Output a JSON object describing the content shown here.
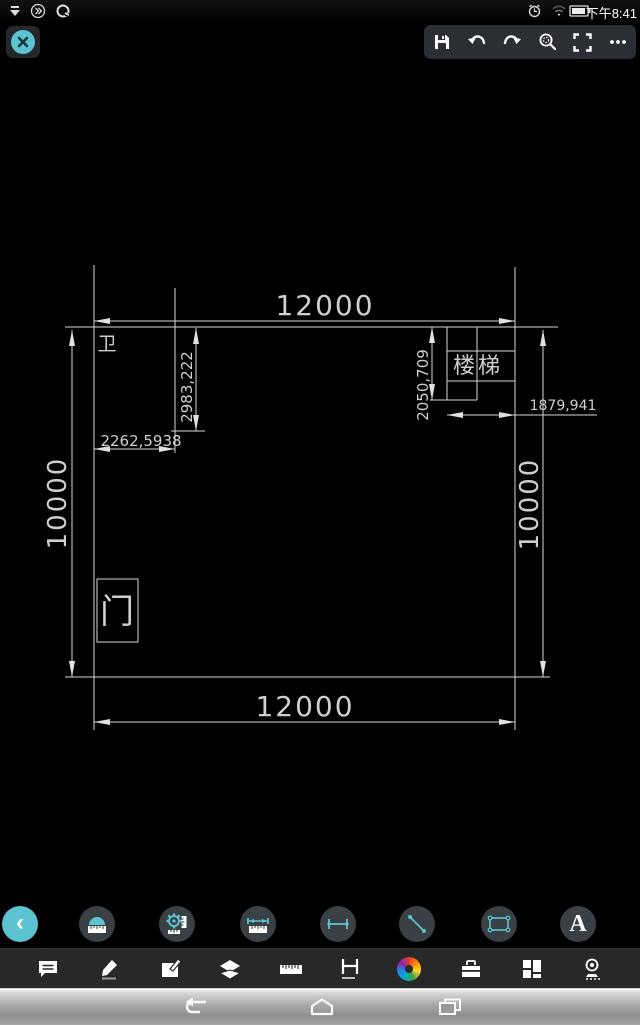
{
  "status_bar": {
    "time": "下午8:41",
    "icons_left": [
      "download-icon",
      "forward-circle-icon",
      "app-notification-icon"
    ],
    "icons_right": [
      "alarm-icon",
      "wifi-icon",
      "battery-icon"
    ]
  },
  "top_toolbar": {
    "buttons": [
      "close",
      "save",
      "undo",
      "redo",
      "zoom",
      "fullscreen",
      "more"
    ]
  },
  "drawing": {
    "dimensions": {
      "top_width": "12000",
      "bottom_width": "12000",
      "left_height": "10000",
      "right_height": "10000",
      "bath_height": "2983,222",
      "bath_width": "2262,5938",
      "stair_height": "2050,709",
      "stair_width": "1879,941"
    },
    "rooms": {
      "bathroom": "卫",
      "stairs": "楼梯",
      "door": "门"
    },
    "line_color": "#d6d6d6"
  },
  "tool_palette": {
    "text_tool_label": "A",
    "items": [
      "collapse-button",
      "arc-measure-tool",
      "scale-settings-tool",
      "dimension-measure-tool",
      "dimension-line-tool",
      "line-tool",
      "rectangle-tool",
      "text-tool"
    ]
  },
  "bottom_toolbar": {
    "items": [
      "comment-tool",
      "pencil-tool",
      "edit-note-tool",
      "layers-tool",
      "ruler-tool",
      "layout-tool",
      "color-wheel-tool",
      "toolbox-tool",
      "blocks-tool",
      "webcam-tool"
    ]
  },
  "nav_bar": {
    "items": [
      "back",
      "home",
      "recents"
    ]
  },
  "colors": {
    "accent_teal": "#5cc3d1",
    "toolbar_bg": "#2b2f33",
    "bottom_bar_bg": "#282828",
    "drawing_stroke": "#d6d6d6"
  }
}
